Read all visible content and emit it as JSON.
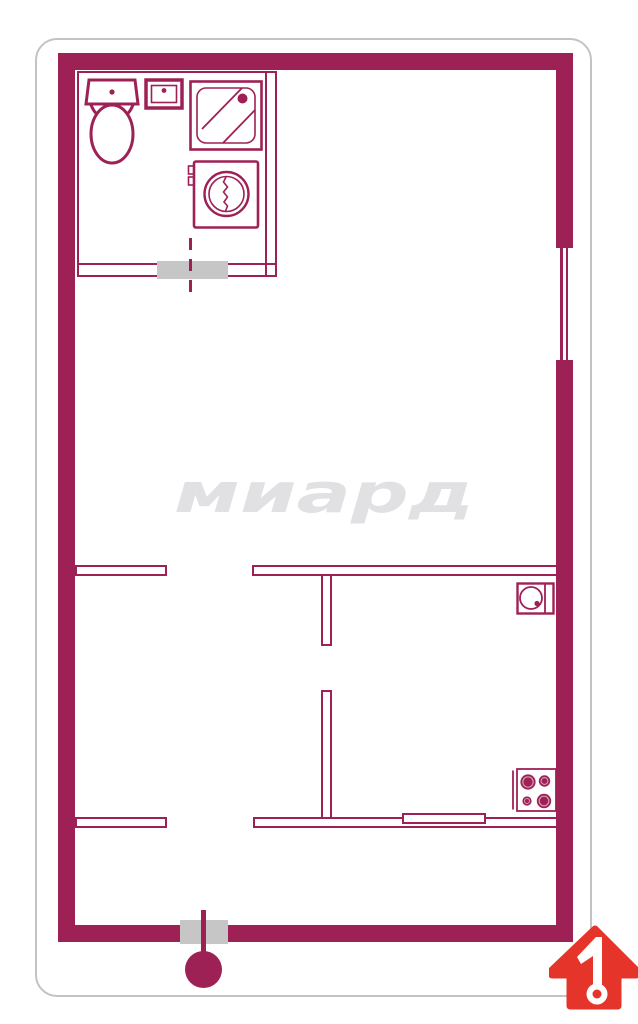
{
  "watermark": {
    "text": "миард"
  },
  "logo": {
    "number": "1",
    "icon": "house-arrow-up-icon"
  },
  "colors": {
    "wall": "#9e2155",
    "marker": "#c6c6c6",
    "logo_red": "#e5352b",
    "watermark": "#e1e1e4",
    "card_border": "#c3c3c5",
    "canvas_bg": "#ffffff"
  },
  "floorplan": {
    "fixture_icons": [
      "toilet-icon",
      "washbasin-icon",
      "shower-cabin-icon",
      "washing-machine-icon",
      "kitchen-sink-icon",
      "stove-icon"
    ],
    "feature_icons": [
      "window-icon",
      "bathroom-door-opening-icon",
      "doorway-gap-icon",
      "sliding-door-icon",
      "entrance-door-icon"
    ]
  }
}
